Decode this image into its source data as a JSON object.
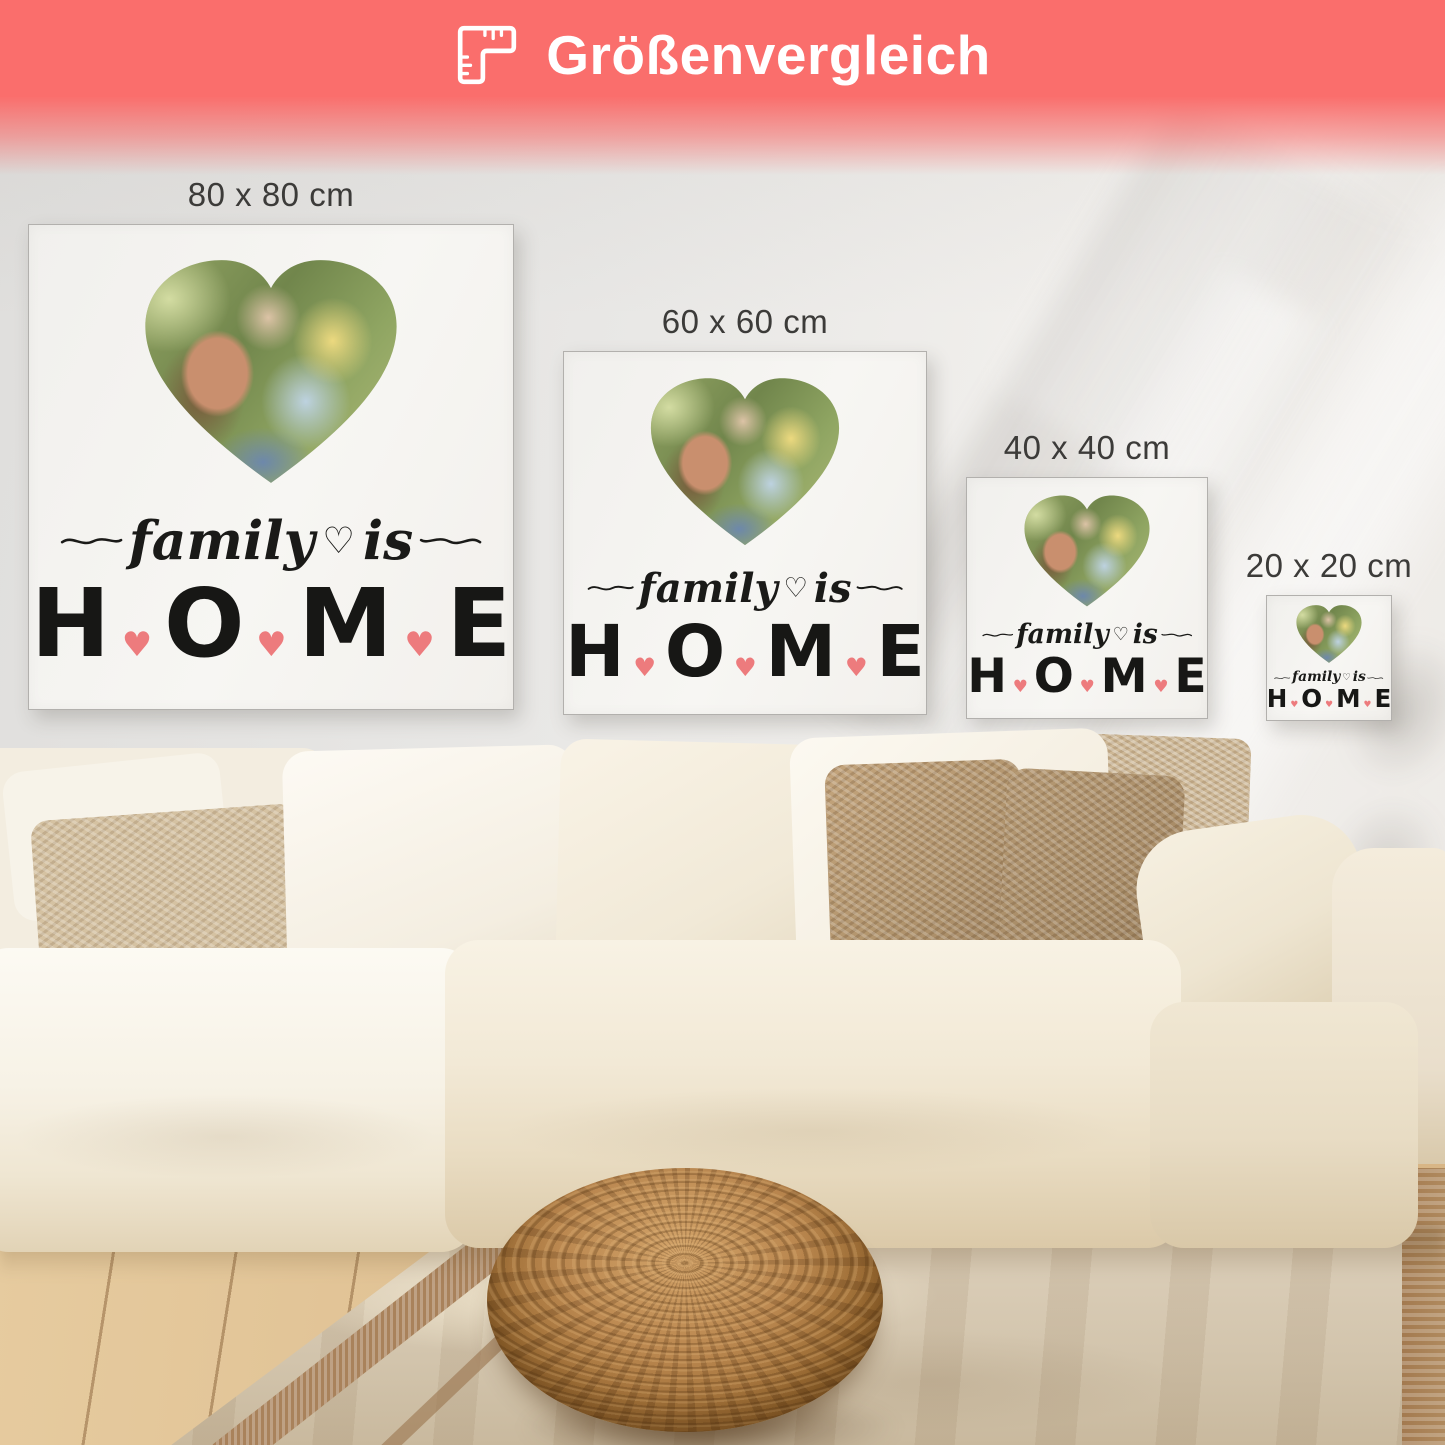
{
  "header": {
    "title": "Größenvergleich"
  },
  "banner": {
    "background_color": "#fa6e6c",
    "text_color": "#ffffff"
  },
  "sizes": [
    {
      "label": "80 x 80 cm"
    },
    {
      "label": "60 x 60 cm"
    },
    {
      "label": "40 x 40 cm"
    },
    {
      "label": "20 x 20 cm"
    }
  ],
  "canvas_text": {
    "script_word_1": "family",
    "heart_outline": "♡",
    "script_word_2": "is",
    "letters": [
      "H",
      "O",
      "M",
      "E"
    ],
    "heart_filled": "♥",
    "heart_color": "#ed7b7d",
    "text_color": "#1a1a18"
  },
  "scene_colors": {
    "wall": "#eceae7",
    "canvas_surface": "#f5f4f1",
    "sofa": "#f4eddd",
    "pillow_brown": "#b1946d",
    "rug": "#d5c8b2",
    "pouf_wicker": "#b8854e",
    "wood_floor": "#dcbb8c"
  }
}
